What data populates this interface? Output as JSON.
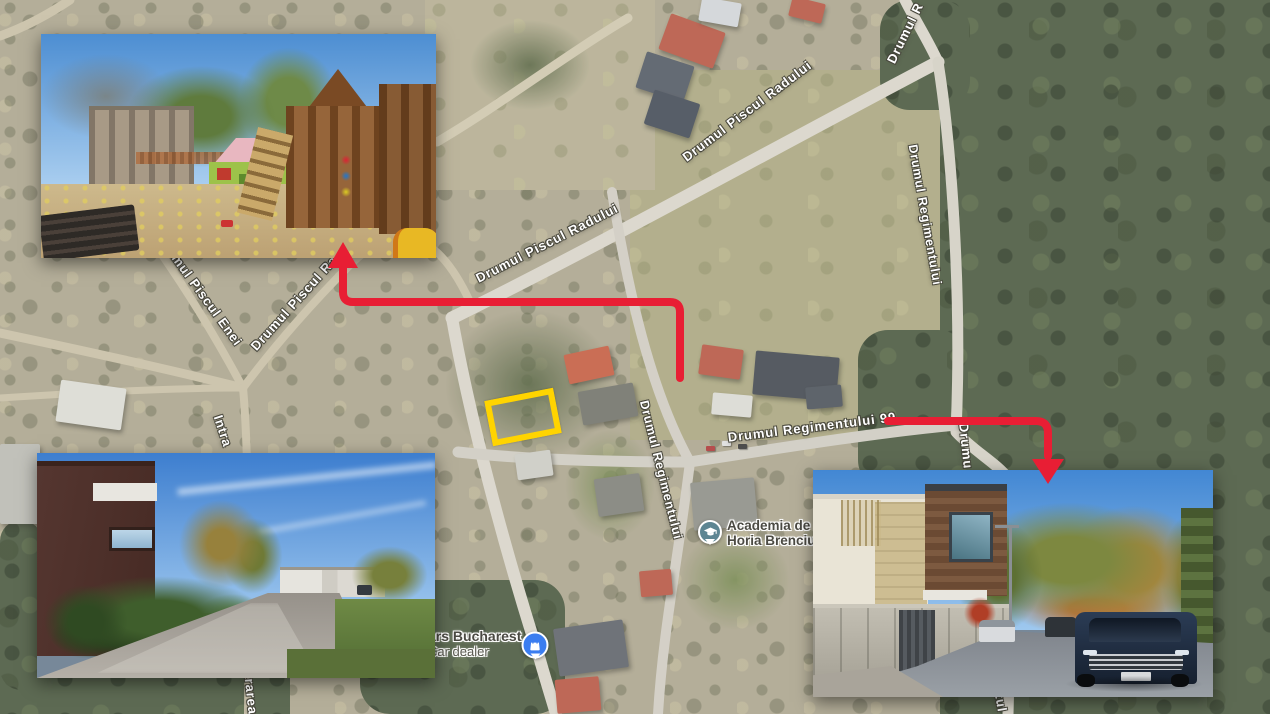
{
  "map": {
    "street_labels": [
      {
        "id": "radului-upper",
        "text": "Drumul Piscul Radului"
      },
      {
        "id": "radului-lower",
        "text": "Drumul Piscul Radului"
      },
      {
        "id": "r-corner",
        "text": "Drumul R"
      },
      {
        "id": "regimentului-right",
        "text": "Drumul Regimentului"
      },
      {
        "id": "regimentului-center",
        "text": "Drumul Regimentului"
      },
      {
        "id": "regimentului-99",
        "text": "Drumul Regimentului 99"
      },
      {
        "id": "piscul-enei-fragment",
        "text": "mul Piscul Enei"
      },
      {
        "id": "piscul-ra-fragment",
        "text": "Drumul Piscul Ra"
      },
      {
        "id": "intra-fragment",
        "text": "Intra"
      },
      {
        "id": "trarea-fragment",
        "text": "trarea"
      },
      {
        "id": "drumu-fragment",
        "text": "Drumu"
      },
      {
        "id": "tul-fragment",
        "text": "tul"
      }
    ],
    "pois": [
      {
        "line1": "Academia de A",
        "line2": "Horia Brenciu",
        "icon": "graduation-cap",
        "pin_color": "#5d8592"
      },
      {
        "line1": "ars Bucharest",
        "line2": "Car dealer",
        "icon": "shopping-bag",
        "pin_color": "#3b7df0"
      }
    ],
    "annotations": {
      "plot_outline_color": "#ffd400",
      "arrow_color": "#e81e34"
    }
  }
}
